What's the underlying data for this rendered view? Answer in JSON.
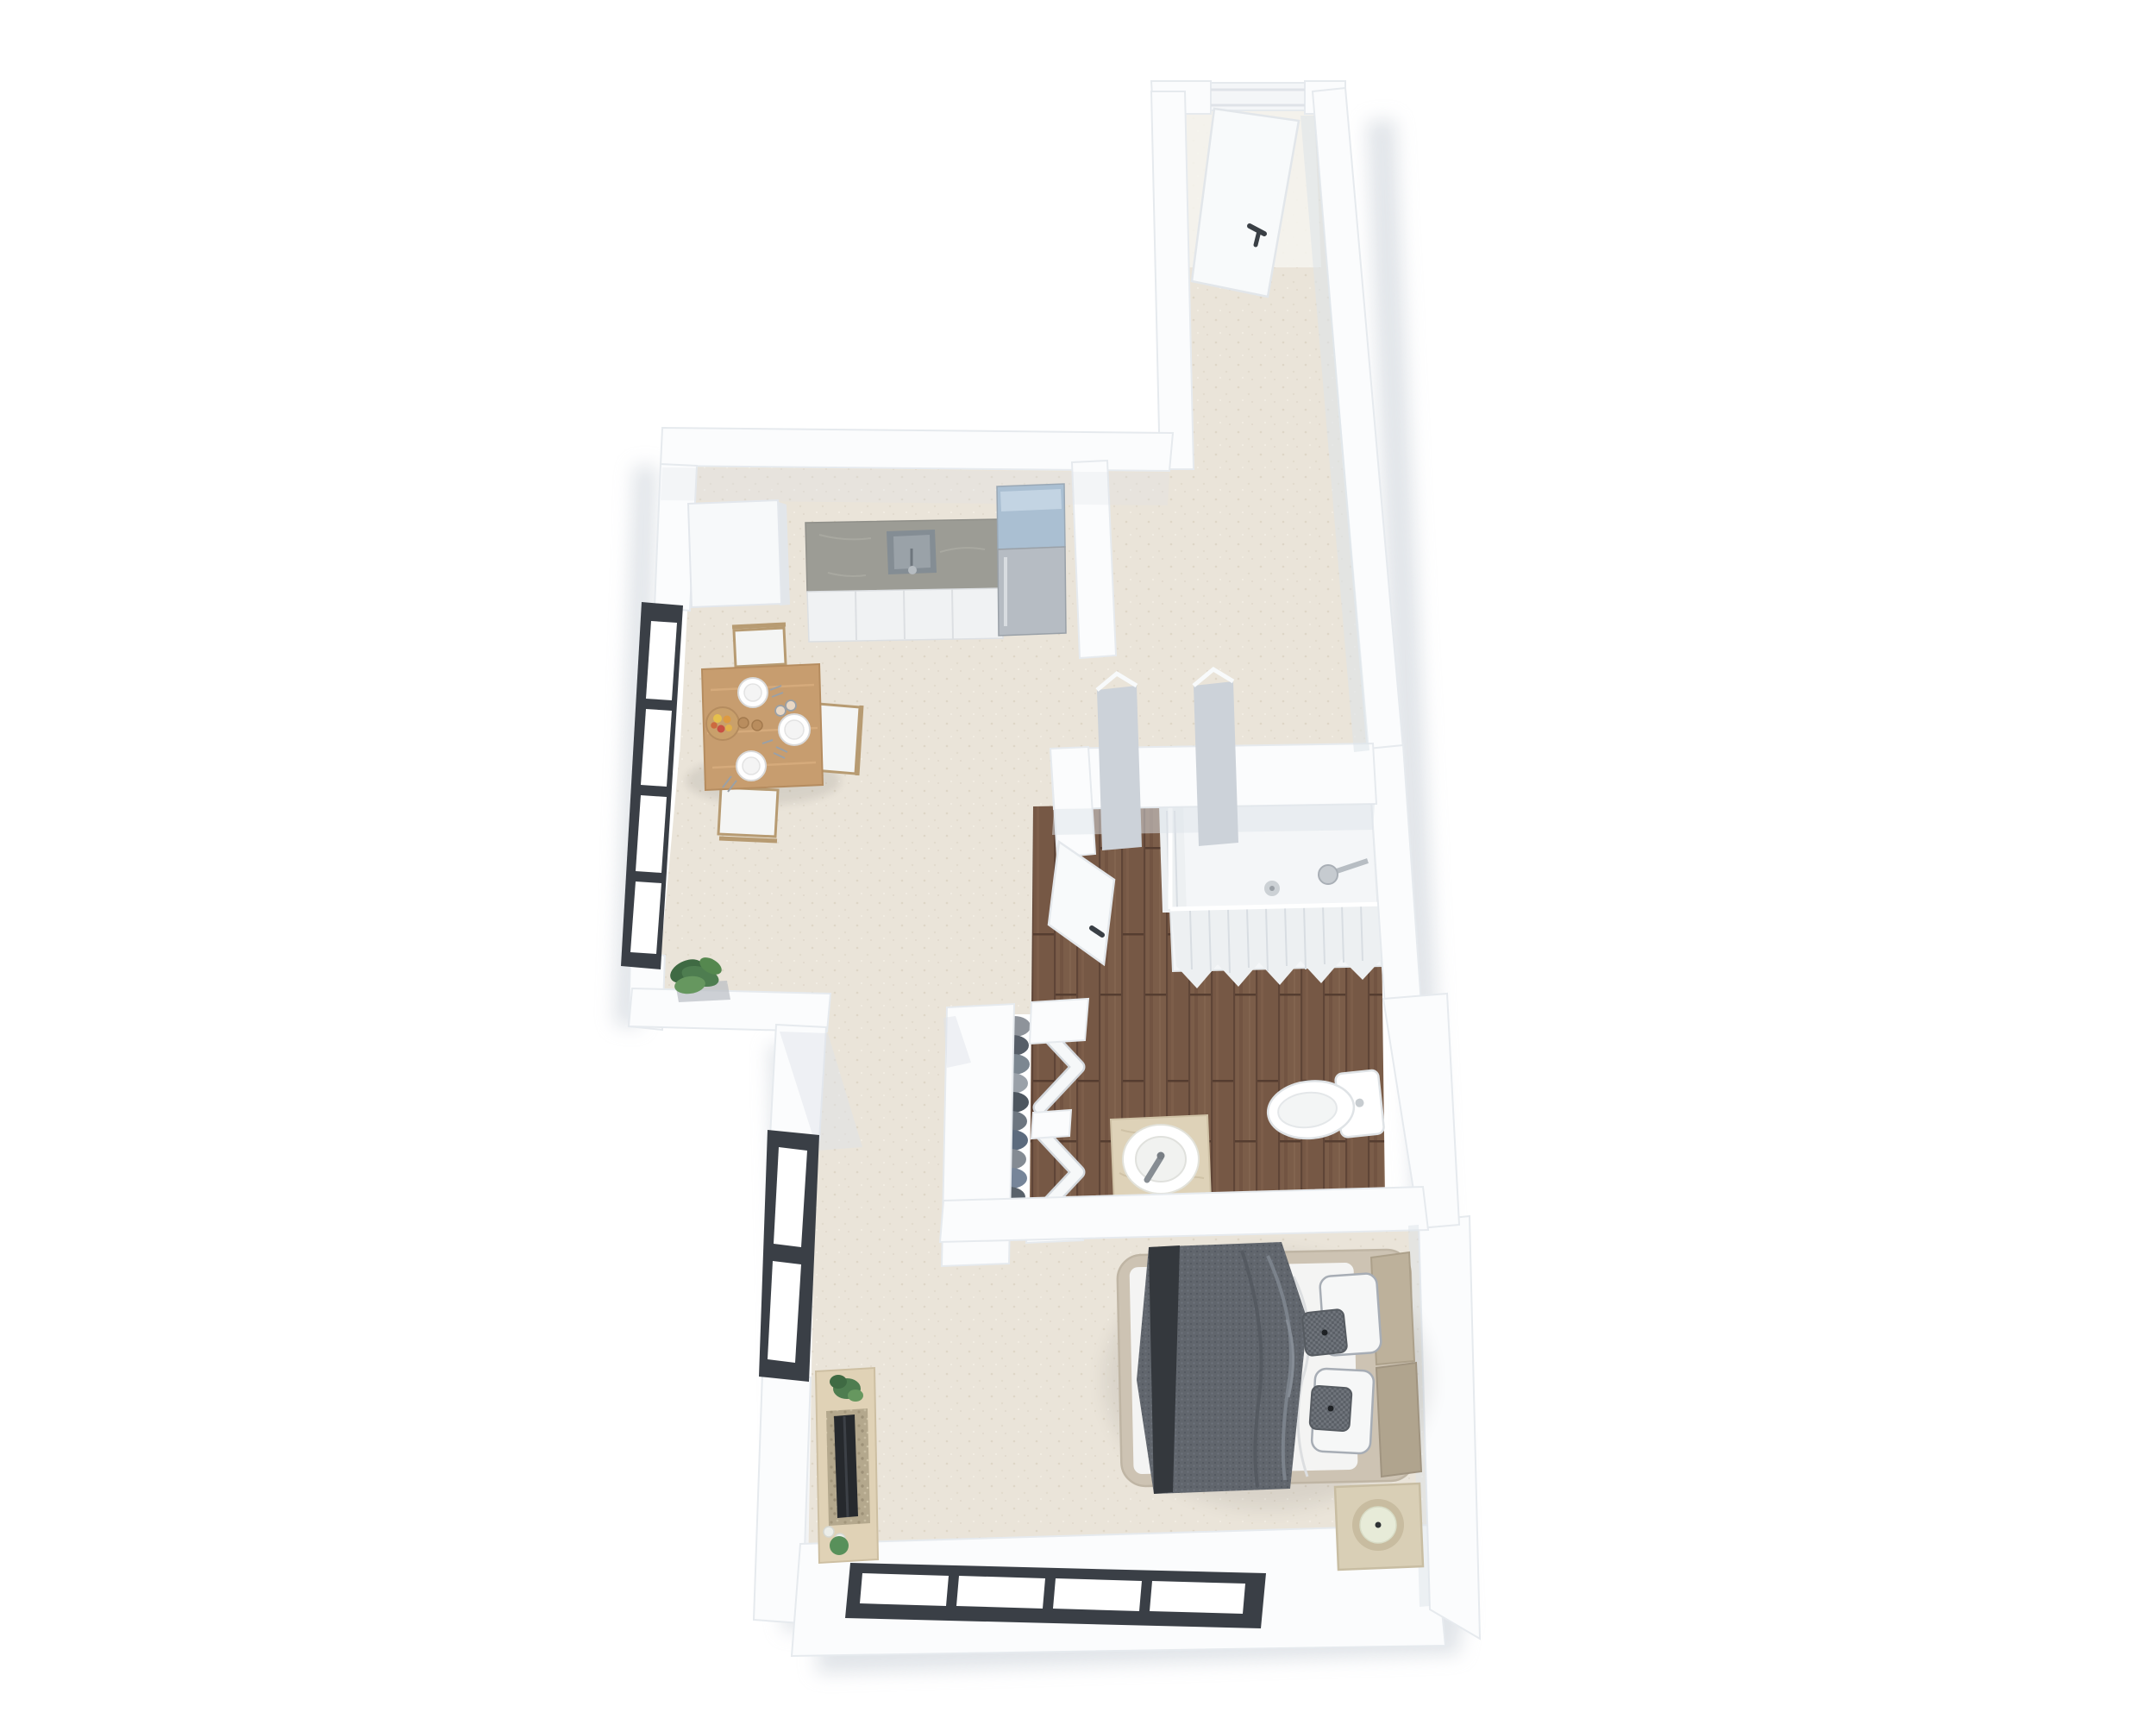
{
  "scene": {
    "kind": "3d-floorplan-top-view-render",
    "rooms": [
      {
        "name": "entry-corridor",
        "floor": "carpet"
      },
      {
        "name": "kitchen",
        "floor": "carpet"
      },
      {
        "name": "dining-area",
        "floor": "carpet"
      },
      {
        "name": "living-area",
        "floor": "carpet"
      },
      {
        "name": "bathroom",
        "floor": "wood-planks"
      },
      {
        "name": "bedroom",
        "floor": "carpet"
      }
    ],
    "furniture": [
      "entry-door-open",
      "pantry-cabinet",
      "kitchen-counter-with-sink",
      "refrigerator",
      "dining-table-with-plates-and-fruit",
      "dining-chairs-x3",
      "floor-plant",
      "leaning-panels-x2",
      "bathroom-door-open",
      "shower-with-curtain",
      "wardrobe-with-clothes",
      "bifold-closet-doors-x2",
      "sink-vanity",
      "toilet",
      "double-bed-with-gray-throw",
      "pillows",
      "nightstand-with-lamp",
      "tv-console-with-plants",
      "window-walls-black-frame"
    ]
  },
  "palette": {
    "wall": "#fbfcfd",
    "wallStroke": "#e6eaee",
    "wallFace": "#dde3e9",
    "shadow": "#c3cad3",
    "carpet": "#eae4d9",
    "wood": "#7b5d49",
    "frameDark": "#3a3f46",
    "pane": "#ffffff",
    "counter": "#9c9c95",
    "cabinet": "#f0f2f3",
    "fridge": "#b6bcc3",
    "fridgeTop": "#aabfd2",
    "pantry": "#f7f9fa",
    "table": "#c79d6f",
    "chairSeat": "#f4f5f4",
    "chairFrame": "#b79b72",
    "plate": "#ffffff",
    "plateRing": "#d9d9d9",
    "board": "#c9a06b",
    "leaf": "#4e7d50",
    "panel": "#ccd2d9",
    "door": "#f8fafb",
    "handle": "#3a3f45",
    "tray": "#f4f6f8",
    "curtain": "#edf0f2",
    "chrome": "#c6cbd0",
    "vanity": "#ded2b8",
    "faucet": "#878d93",
    "toilet": "#ffffff",
    "bedFrame": "#cdc3b3",
    "duvet": "#f4f4f3",
    "throwDark": "#34383d",
    "pillow": "#f6f7f7",
    "pillowTrim": "#a7adb5",
    "cushion": "#70757c",
    "bolster": "#bdb19b",
    "nightstand": "#d9cfb6",
    "ring": "#c8bca0",
    "sphere": "#e7ebd8",
    "console": "#e0d2b6",
    "tv": "#26292d",
    "pebble": "#eceee9"
  }
}
